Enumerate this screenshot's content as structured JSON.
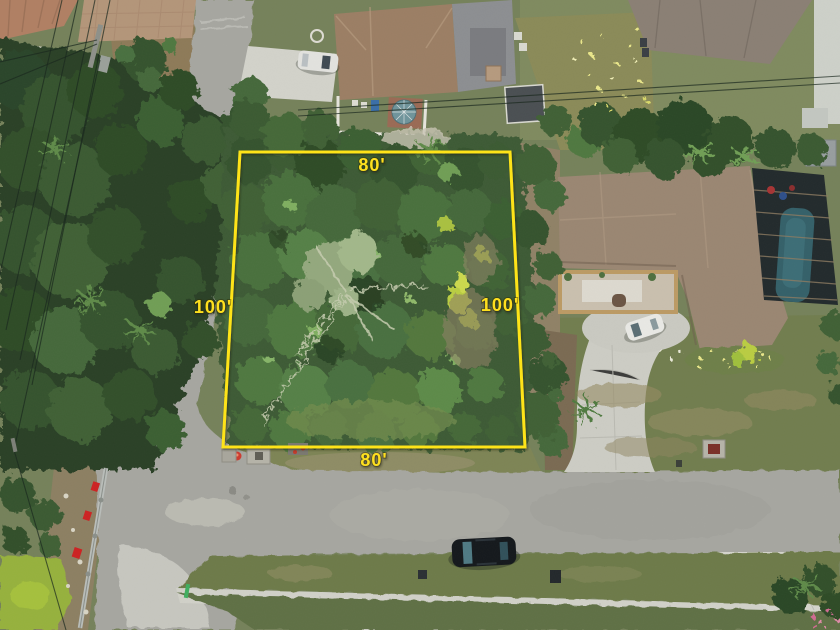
{
  "scene": {
    "type": "aerial-drone-photo",
    "subject": "vacant wooded residential lot outlined in yellow",
    "features": [
      "tree-canopy-lot",
      "yellow-boundary-overlay",
      "residential-street",
      "sidewalk",
      "neighboring-houses",
      "screened-pool",
      "parked-cars",
      "power-lines",
      "fire-hydrant",
      "utility-pipe",
      "pond"
    ]
  },
  "lot_outline": {
    "points": "240,152 510,152 525,447 223,447",
    "stroke_color": "#ffe414",
    "label_color": "#ffe01c",
    "labels": {
      "top": "80'",
      "bottom": "80'",
      "left": "100'",
      "right": "100'"
    }
  },
  "palette": {
    "canopy_dark": "#2c4429",
    "canopy_mid": "#47683c",
    "canopy_light": "#6f9e55",
    "sage_deadwood": "#9db287",
    "road_asphalt": "#a6a6a0",
    "road_worn": "#c6c6bf",
    "concrete": "#d0d0c8",
    "roof_brown": "#9a8672",
    "roof_shingle": "#9b7e64",
    "roof_gray": "#8c8e91",
    "pool_water": "#346069",
    "screen_enclosure": "#222a2c",
    "pond_green": "#96b13c",
    "dirt": "#8f8166",
    "lawn": "#717d4e",
    "hydrant_red": "#cc3b2f"
  }
}
